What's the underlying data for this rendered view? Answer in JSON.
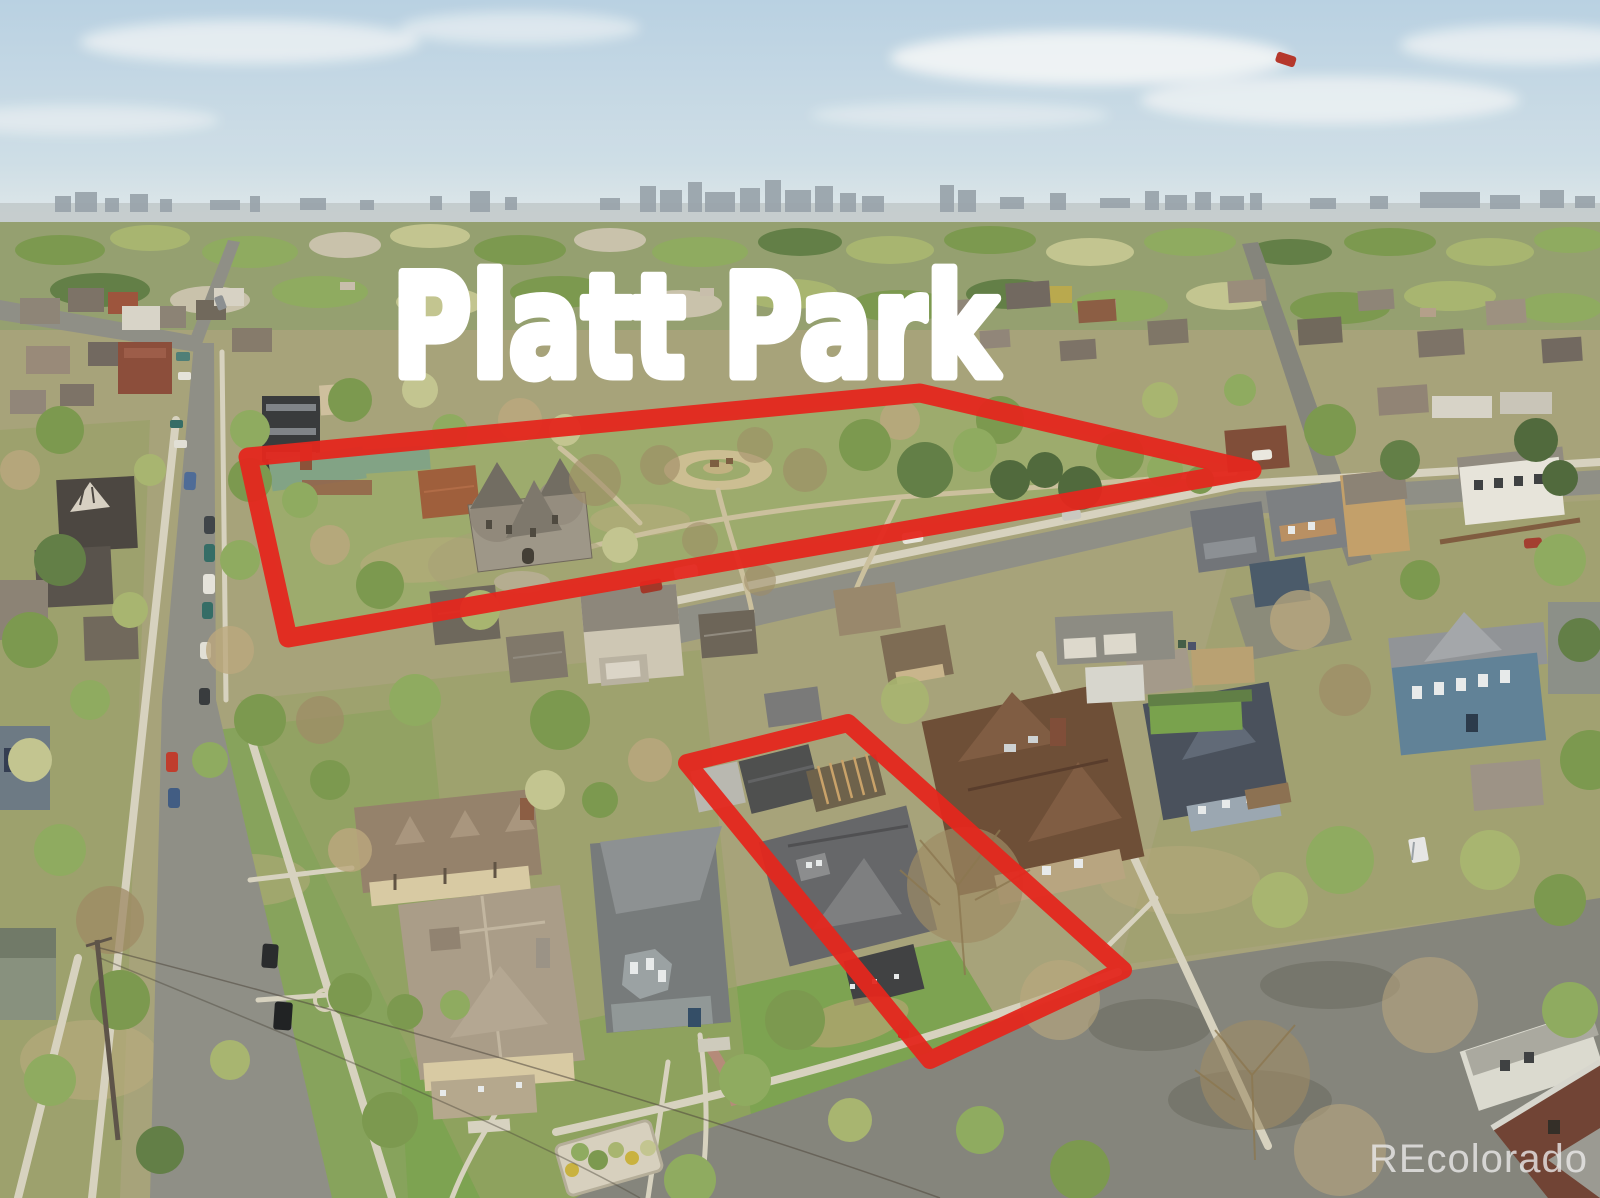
{
  "title_overlay": {
    "text": "Platt Park"
  },
  "watermark": {
    "text": "REcolorado"
  },
  "annotations": {
    "marker_color": "#e4271d",
    "park_outline": {
      "points": "248,457 920,393 1252,470 288,638",
      "stroke_width": 19
    },
    "property_outline": {
      "points": "687,763 848,723 1123,970 930,1060",
      "stroke_width": 18
    }
  },
  "scene": {
    "type": "aerial-photo",
    "description": "Drone aerial view of the Platt Park neighborhood: tree-lined residential blocks, a public park outlined in red, a listed property lot outlined in red, and a hazy downtown skyline on the horizon.",
    "sky_color": "#b9d3e8",
    "park_grass_color": "#9cab6e",
    "street_color": "#8d8e88",
    "title_color": "#ffffff",
    "watermark_color": "#ececec"
  }
}
